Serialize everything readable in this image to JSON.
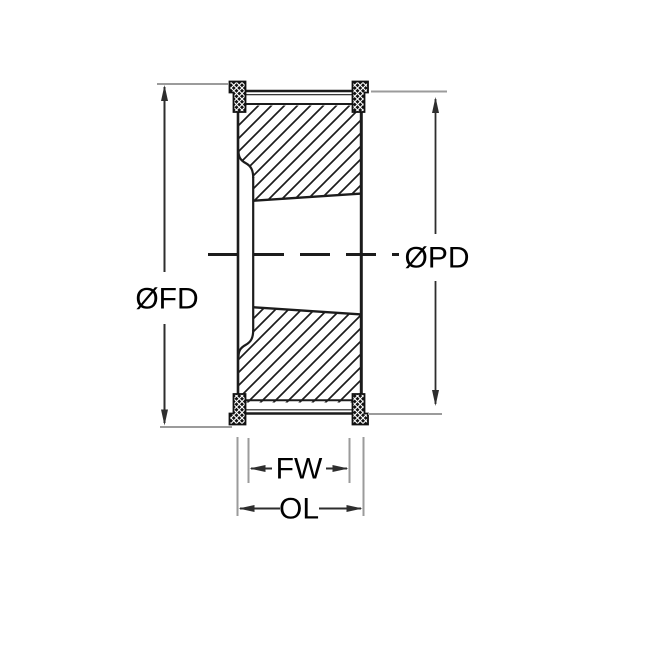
{
  "diagram": {
    "type": "technical-drawing",
    "subject": "timing-pulley-cross-section-with-flanges-and-taper-bush",
    "dimension_labels": {
      "flange_diameter": "ØFD",
      "pitch_diameter": "ØPD",
      "face_width": "FW",
      "overall_length": "OL"
    },
    "colors": {
      "outline": "#1c1c1c",
      "dimension_line": "#2e2e2e",
      "extension_line": "#9b9b9b",
      "background": "#ffffff"
    }
  }
}
